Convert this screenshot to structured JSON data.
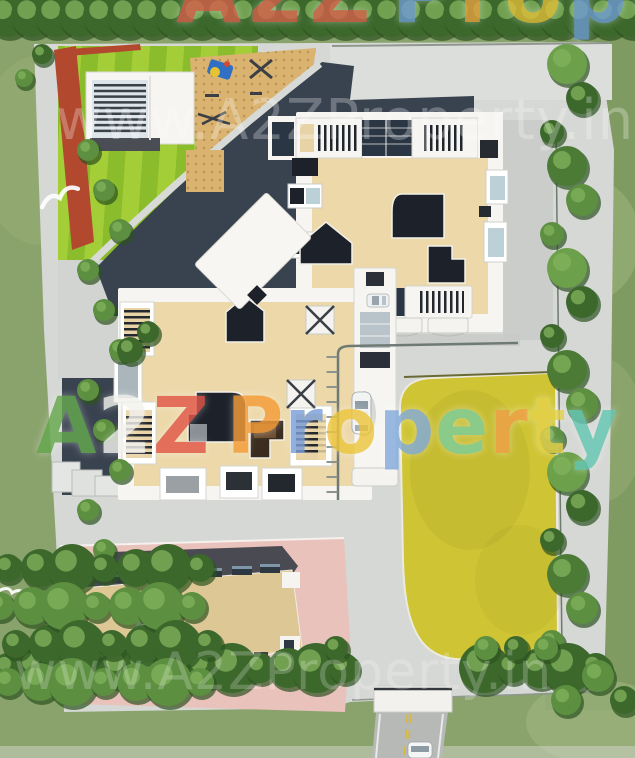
{
  "watermarks": {
    "url_top": "www.A2ZProperty.in",
    "url_bottom": "www.A2ZProperty.in",
    "brand_top": {
      "word1": [
        {
          "ch": "A",
          "color": "#d95f4b"
        },
        {
          "ch": "2",
          "color": "#d95f4b"
        },
        {
          "ch": "Z",
          "color": "#d95f4b"
        }
      ],
      "word2": [
        {
          "ch": "P",
          "color": "#6f9cd6"
        },
        {
          "ch": "r",
          "color": "#e8a23f"
        },
        {
          "ch": "o",
          "color": "#e3bf3a"
        },
        {
          "ch": "p",
          "color": "#6f9cd6"
        },
        {
          "ch": "e",
          "color": "#e8a23f"
        },
        {
          "ch": "r",
          "color": "#7ecf9d"
        },
        {
          "ch": "t",
          "color": "#e3bf3a"
        },
        {
          "ch": "y",
          "color": "#6cc9b5"
        }
      ]
    },
    "brand_middle": {
      "word1": [
        {
          "ch": "A",
          "color": "#66a94e"
        },
        {
          "ch": "2",
          "color": "#f2f2ee"
        },
        {
          "ch": "Z",
          "color": "#e2584a"
        }
      ],
      "word2": [
        {
          "ch": "P",
          "color": "#f59d3a"
        },
        {
          "ch": "r",
          "color": "#7b9fd8"
        },
        {
          "ch": "o",
          "color": "#edc63e"
        },
        {
          "ch": "p",
          "color": "#84abdc"
        },
        {
          "ch": "e",
          "color": "#7ecf9d"
        },
        {
          "ch": "r",
          "color": "#f0a049"
        },
        {
          "ch": "t",
          "color": "#e6d34c"
        },
        {
          "ch": "y",
          "color": "#66c8b5"
        }
      ]
    }
  },
  "palette": {
    "grass": "#8aa26c",
    "grass_dark": "#7d9a60",
    "pavement": "#d6d8d5",
    "pavement_shade": "#c9ccc9",
    "lawn_a": "#a4ce37",
    "lawn_b": "#8abc2b",
    "accent_red": "#b2492f",
    "sand": "#d9b36f",
    "roof_beige": "#ecd8a9",
    "parapet_white": "#f6f5f1",
    "courtyard_dark": "#1d222a",
    "shadow_navy": "#39424f",
    "lawn_yellow": "#cfc433",
    "plaza_pink": "#e9c2bc",
    "roof_tan": "#dcc795",
    "road_gray": "#b6b9b6",
    "road_line_yellow": "#d8b93c",
    "glass_blue": "#bcd0d8",
    "tree_green": "#4c7b36"
  }
}
